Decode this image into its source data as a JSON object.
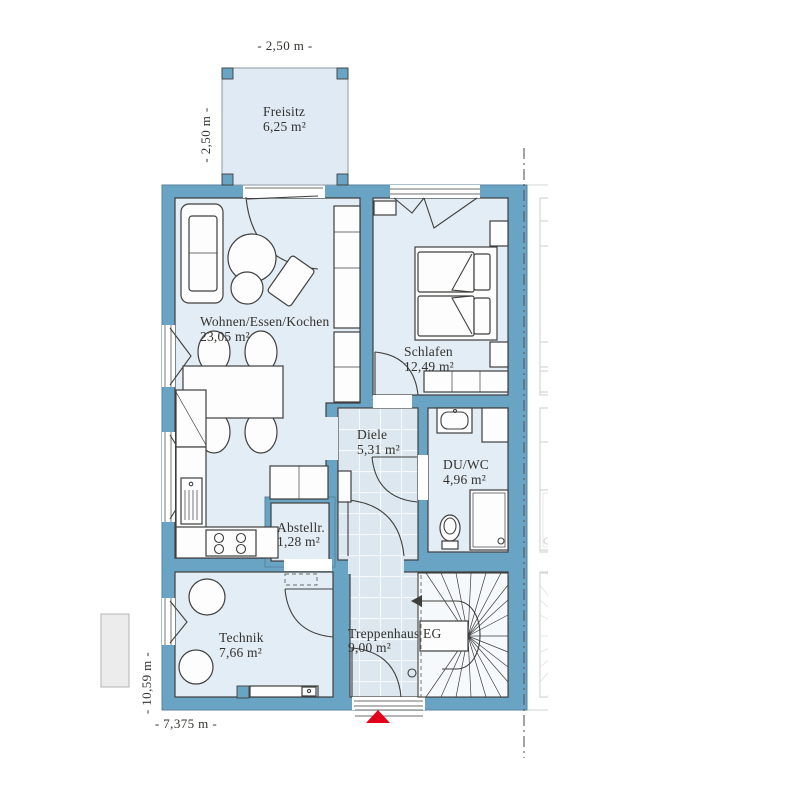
{
  "plan": {
    "rooms": {
      "freisitz": {
        "name": "Freisitz",
        "area": "6,25 m²"
      },
      "wohnen": {
        "name": "Wohnen/Essen/Kochen",
        "area": "23,05 m²"
      },
      "schlafen": {
        "name": "Schlafen",
        "area": "12,49 m²"
      },
      "diele": {
        "name": "Diele",
        "area": "5,31 m²"
      },
      "duwc": {
        "name": "DU/WC",
        "area": "4,96 m²"
      },
      "abstell": {
        "name": "Abstellr.",
        "area": "1,28 m²"
      },
      "technik": {
        "name": "Technik",
        "area": "7,66 m²"
      },
      "treppenhaus": {
        "name": "Treppenhaus EG",
        "area": "9,00 m²"
      }
    },
    "dimensions": {
      "terrace_width": "- 2,50 m -",
      "terrace_depth": "- 2,50 m -",
      "house_width": "- 7,375 m -",
      "house_depth": "- 10,59 m -"
    },
    "colors": {
      "wall": "#69A4C5",
      "room_fill": "#E3EDF6",
      "tile_fill": "#DCE7EF",
      "terrace_fill": "#DFEAF4",
      "ink": "#3F3F3D",
      "ghost": "#CDD0D3",
      "entrance_marker": "#E2001A"
    }
  }
}
